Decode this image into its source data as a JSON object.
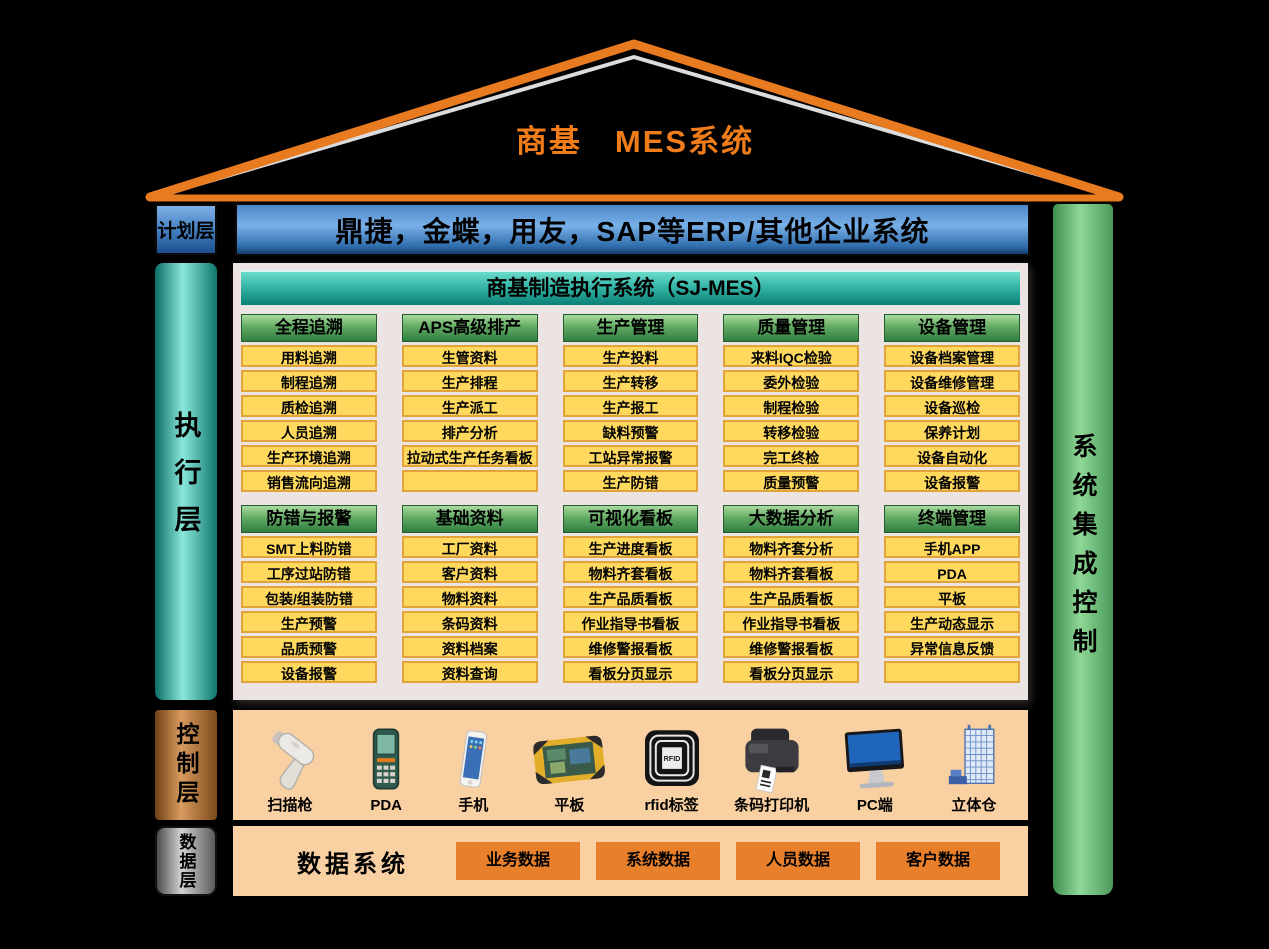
{
  "title": "商基　MES系统",
  "planning": {
    "label": "计划层",
    "bar": "鼎捷，金蝶，用友，SAP等ERP/其他企业系统"
  },
  "execution": {
    "label": "执行层",
    "header": "商基制造执行系统（SJ-MES）",
    "rows": [
      {
        "columns": [
          {
            "header": "全程追溯",
            "items": [
              "用料追溯",
              "制程追溯",
              "质检追溯",
              "人员追溯",
              "生产环境追溯",
              "销售流向追溯"
            ]
          },
          {
            "header": "APS高级排产",
            "items": [
              "生管资料",
              "生产排程",
              "生产派工",
              "排产分析",
              "拉动式生产任务看板",
              ""
            ]
          },
          {
            "header": "生产管理",
            "items": [
              "生产投料",
              "生产转移",
              "生产报工",
              "缺料预警",
              "工站异常报警",
              "生产防错"
            ]
          },
          {
            "header": "质量管理",
            "items": [
              "来料IQC检验",
              "委外检验",
              "制程检验",
              "转移检验",
              "完工终检",
              "质量预警"
            ]
          },
          {
            "header": "设备管理",
            "items": [
              "设备档案管理",
              "设备维修管理",
              "设备巡检",
              "保养计划",
              "设备自动化",
              "设备报警"
            ]
          }
        ]
      },
      {
        "columns": [
          {
            "header": "防错与报警",
            "items": [
              "SMT上料防错",
              "工序过站防错",
              "包装/组装防错",
              "生产预警",
              "品质预警",
              "设备报警"
            ]
          },
          {
            "header": "基础资料",
            "items": [
              "工厂资料",
              "客户资料",
              "物料资料",
              "条码资料",
              "资料档案",
              "资料查询"
            ]
          },
          {
            "header": "可视化看板",
            "items": [
              "生产进度看板",
              "物料齐套看板",
              "生产品质看板",
              "作业指导书看板",
              "维修警报看板",
              "看板分页显示"
            ]
          },
          {
            "header": "大数据分析",
            "items": [
              "物料齐套分析",
              "物料齐套看板",
              "生产品质看板",
              "作业指导书看板",
              "维修警报看板",
              "看板分页显示"
            ]
          },
          {
            "header": "终端管理",
            "items": [
              "手机APP",
              "PDA",
              "平板",
              "生产动态显示",
              "异常信息反馈",
              ""
            ]
          }
        ]
      }
    ]
  },
  "integration": {
    "label": "系统集成控制"
  },
  "control": {
    "label": "控制层",
    "devices": [
      {
        "name": "扫描枪",
        "icon": "scanner-icon"
      },
      {
        "name": "PDA",
        "icon": "pda-icon"
      },
      {
        "name": "手机",
        "icon": "phone-icon"
      },
      {
        "name": "平板",
        "icon": "tablet-icon"
      },
      {
        "name": "rfid标签",
        "icon": "rfid-icon",
        "icon_text": "RFID"
      },
      {
        "name": "条码打印机",
        "icon": "printer-icon"
      },
      {
        "name": "PC端",
        "icon": "pc-icon"
      },
      {
        "name": "立体仓",
        "icon": "warehouse-icon"
      }
    ]
  },
  "data_layer": {
    "label": "数据层",
    "title": "数据系统",
    "boxes": [
      "业务数据",
      "系统数据",
      "人员数据",
      "客户数据"
    ]
  },
  "colors": {
    "roof_orange": "#e87a1f",
    "title_orange": "#f07d1a",
    "erp_blue": "#4a86c8",
    "exec_teal": "#0f776e",
    "header_green": "#2f7e41",
    "item_yellow": "#ffd95e",
    "item_border": "#e2a33a",
    "integration_green": "#4a9a5c",
    "control_copper": "#b97a3c",
    "data_gray": "#8c8c8c",
    "panel_peach": "#f8d0a2",
    "panel_gray": "#ebe4e2",
    "data_box_orange": "#e8802b"
  }
}
